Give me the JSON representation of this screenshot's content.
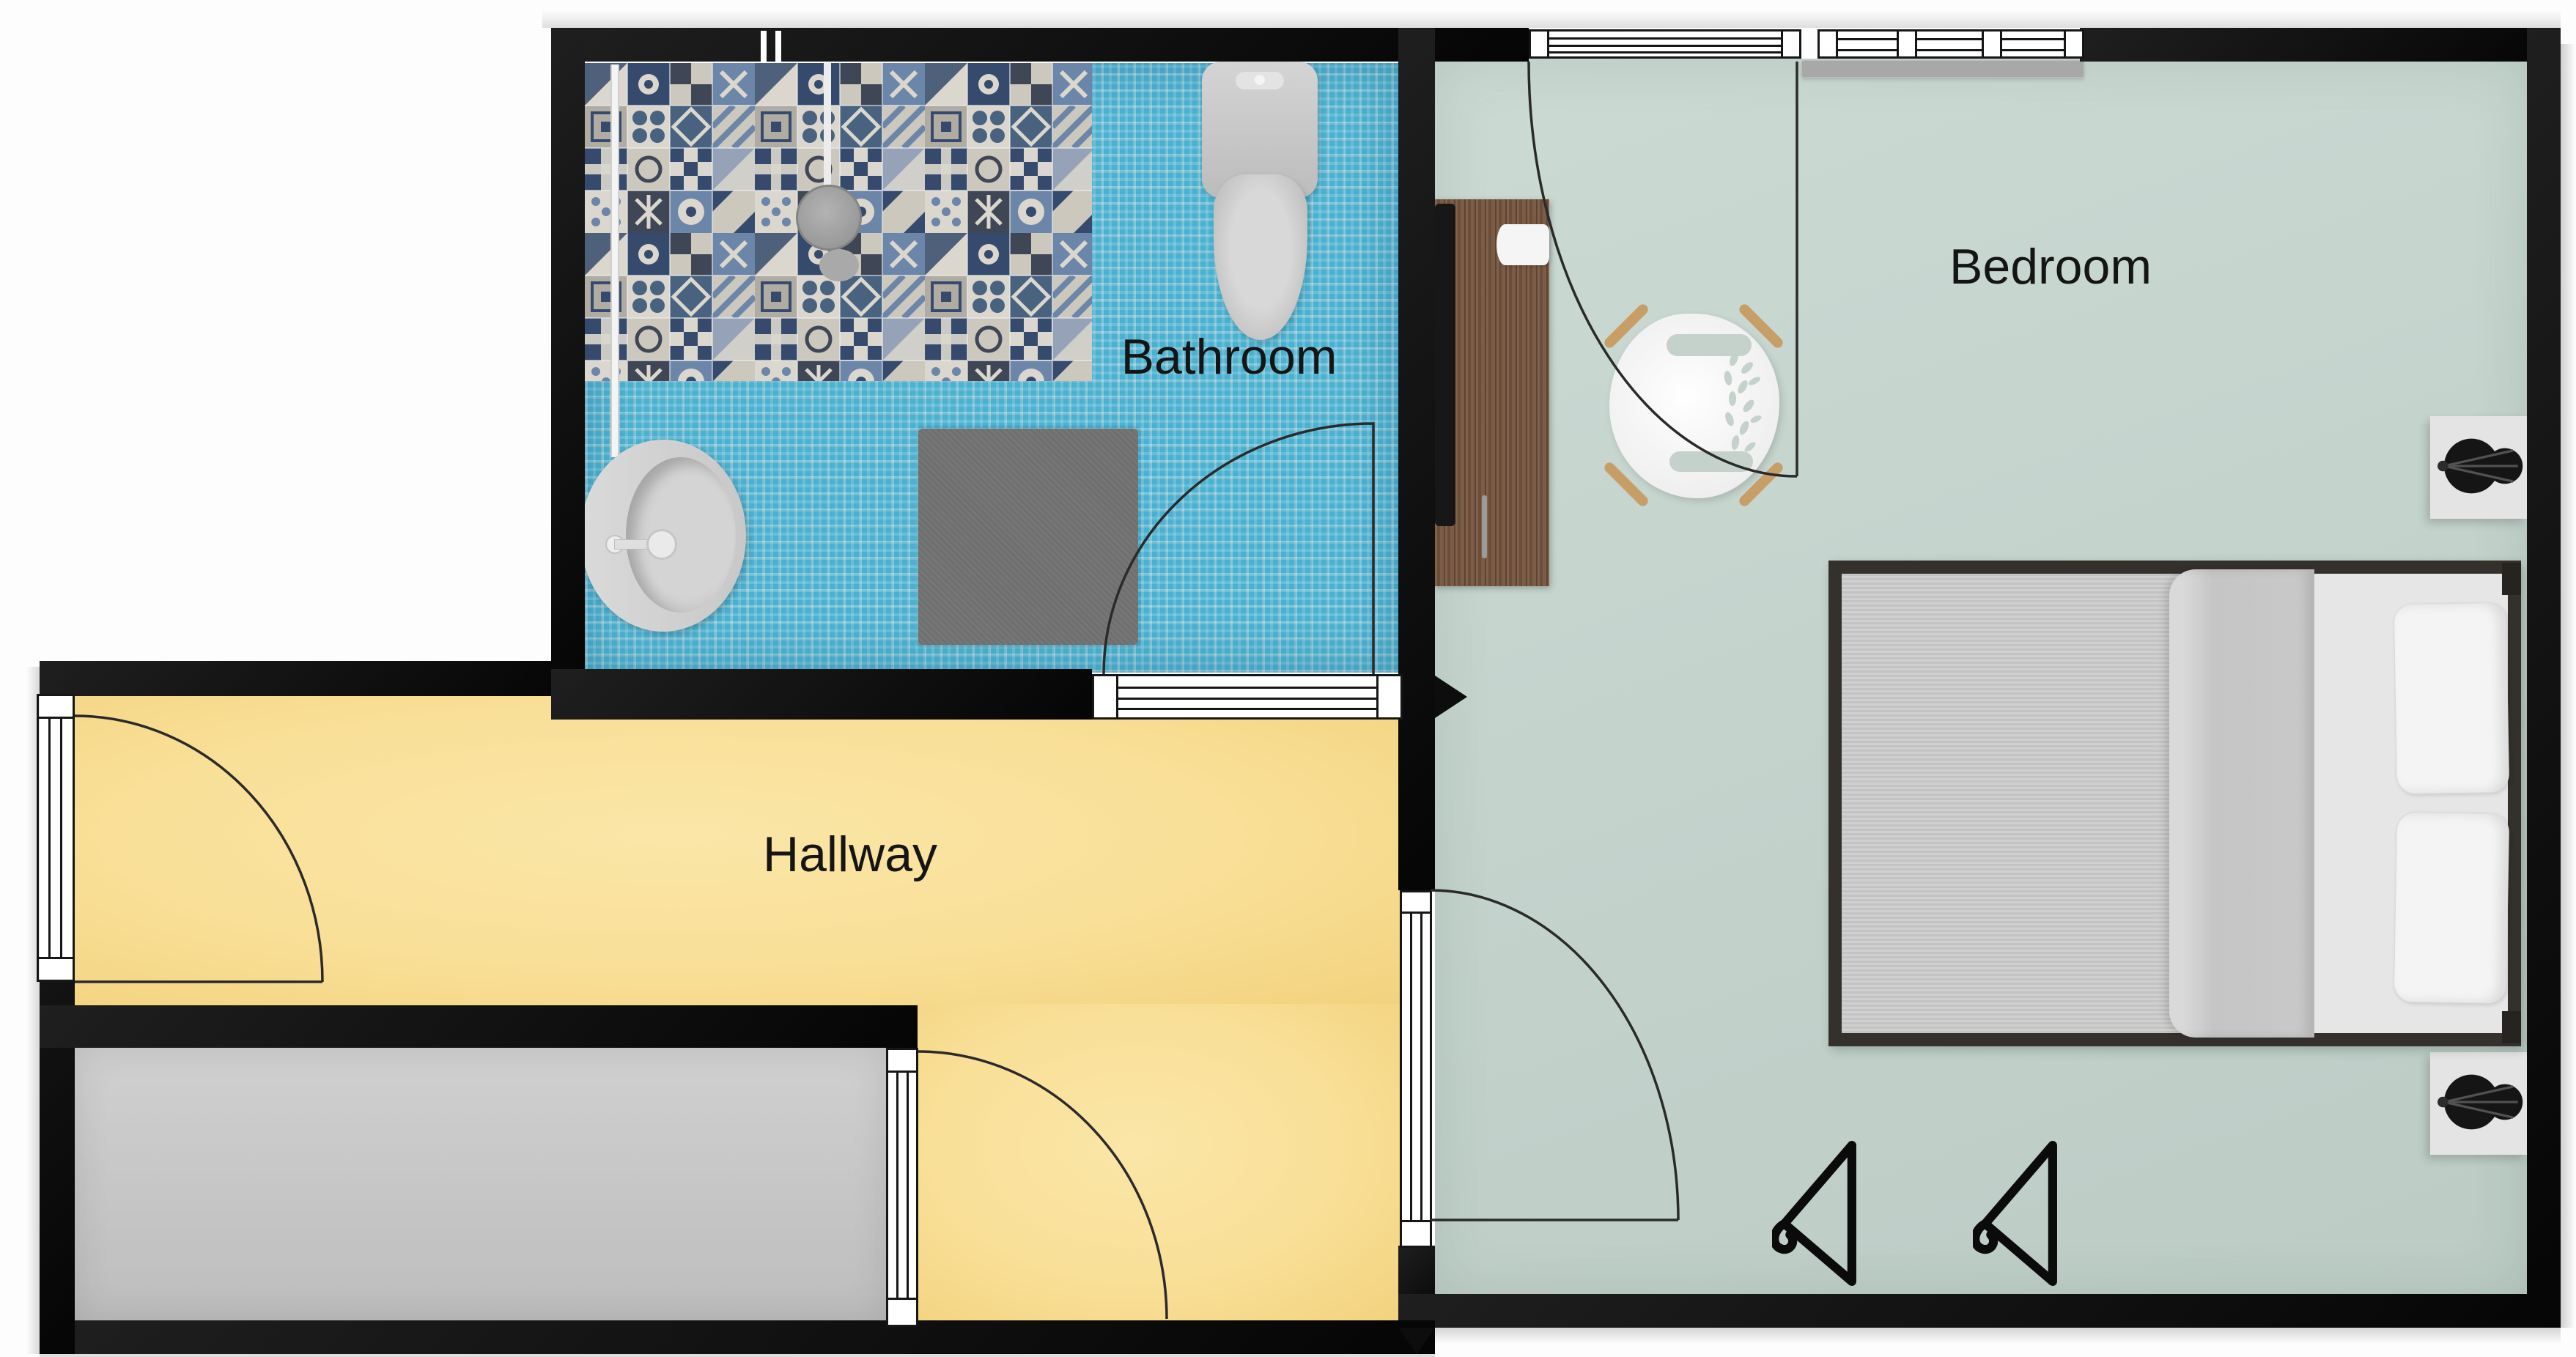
{
  "title": "Apartment floor plan",
  "rooms": {
    "bathroom": {
      "label": "Bathroom",
      "floor_color": "#4ab1d0"
    },
    "bedroom": {
      "label": "Bedroom",
      "floor_color": "#c4d3cc"
    },
    "hallway": {
      "label": "Hallway",
      "floor_color": "#f9df97"
    },
    "storage": {
      "label": "",
      "floor_color": "#c8c8c8"
    }
  },
  "palette": {
    "wall": "#101010",
    "door_frame": "#ffffff",
    "door_arc": "#2a2a2a",
    "radiator": "#a8a8a8",
    "rug": "#6f6f6f",
    "desk_wood": "#775741",
    "bed_frame": "#34302c",
    "lamp": "#151515",
    "chair_legs": "#c79e66",
    "shower_head": "#9c9c9c"
  },
  "furniture": [
    "shower-area",
    "shower-head",
    "shower-screen",
    "toilet",
    "sink",
    "bath-rug",
    "desk",
    "monitor",
    "paper",
    "pen",
    "desk-chair",
    "double-bed",
    "pillow",
    "pillow",
    "nightstand",
    "nightstand",
    "table-lamp",
    "table-lamp",
    "hanger-icon",
    "hanger-icon",
    "window",
    "radiator"
  ]
}
